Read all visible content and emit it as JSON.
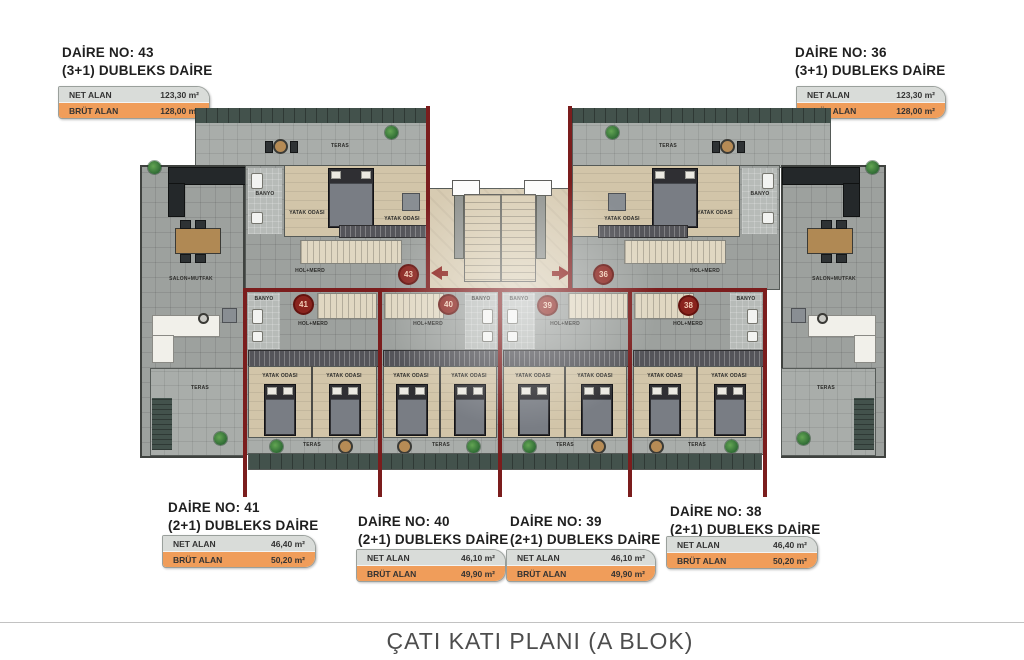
{
  "title": "ÇATI KATI PLANI (A BLOK)",
  "labels": {
    "net": "NET ALAN",
    "brut": "BRÜT ALAN"
  },
  "units": [
    {
      "id": "43",
      "title": "DAİRE NO: 43",
      "subtitle": "(3+1) DUBLEKS DAİRE",
      "net": "123,30 m²",
      "brut": "128,00 m²"
    },
    {
      "id": "36",
      "title": "DAİRE NO: 36",
      "subtitle": "(3+1) DUBLEKS DAİRE",
      "net": "123,30 m²",
      "brut": "128,00 m²"
    },
    {
      "id": "41",
      "title": "DAİRE NO: 41",
      "subtitle": "(2+1) DUBLEKS DAİRE",
      "net": "46,40 m²",
      "brut": "50,20 m²"
    },
    {
      "id": "40",
      "title": "DAİRE NO: 40",
      "subtitle": "(2+1) DUBLEKS DAİRE",
      "net": "46,10 m²",
      "brut": "49,90 m²"
    },
    {
      "id": "39",
      "title": "DAİRE NO: 39",
      "subtitle": "(2+1) DUBLEKS DAİRE",
      "net": "46,10 m²",
      "brut": "49,90 m²"
    },
    {
      "id": "38",
      "title": "DAİRE NO: 38",
      "subtitle": "(2+1) DUBLEKS DAİRE",
      "net": "46,40 m²",
      "brut": "50,20 m²"
    }
  ],
  "rooms": {
    "bedroom": "YATAK ODASI",
    "bathroom": "BANYO",
    "hall": "HOL+MERD",
    "living": "SALON+MUTFAK",
    "terrace": "TERAS"
  },
  "colors": {
    "accent_red": "#7b1d1d",
    "net_row_bg": "#d9dcd9",
    "brut_row_bg": "#f09d5a",
    "deck_green": "#43524c",
    "floor_gray": "#9da19e",
    "floor_beige": "#d2c5a9"
  }
}
